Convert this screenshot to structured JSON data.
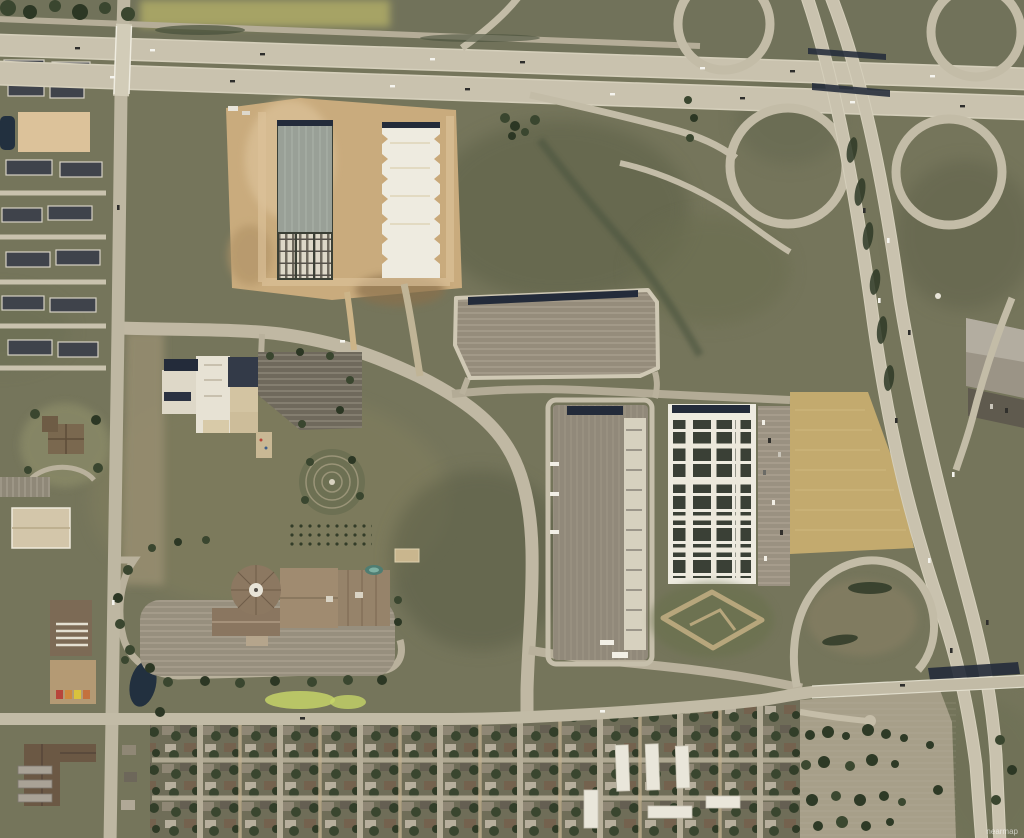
{
  "meta": {
    "title": "Aerial imagery - suburban freeway interchange and logistics district",
    "image_type": "orthographic aerial photograph",
    "watermark": "nearmap"
  },
  "palette": {
    "grass": "#75755b",
    "grass_dark": "#5c6046",
    "grass_light": "#8d8769",
    "scrub": "#837c60",
    "dirt": "#c9ab7d",
    "dirt_light": "#dcc29a",
    "road": "#c9c2ae",
    "road_minor": "#b9b19c",
    "asphalt": "#8f8878",
    "lot_dark": "#6e6859",
    "concrete": "#d7d1bf",
    "roof_white": "#eeebe0",
    "roof_gray": "#99a097",
    "navy": "#232b3a",
    "solar": "#3a4036",
    "tree": "#3a462f",
    "tree_dark": "#2c3724",
    "pond": "#22303f",
    "golden_field": "#c3aa6e",
    "lime": "#c6d468",
    "school_tan": "#d3c4a2",
    "church_brown": "#8c7861",
    "town_roof": "#3f434b"
  },
  "features": {
    "freeway_ew": "east-west freeway",
    "freeway_diagonal": "diagonal freeway",
    "interchange": "cloverleaf interchange",
    "construction": "warehouse construction site",
    "logistics": "logistics buildings and truck courts",
    "school": "school campus",
    "church": "domed church campus",
    "townhomes": "townhome subdivision",
    "residential": "residential street grid",
    "nursery": "tree nursery field",
    "golden_field": "golden crop field"
  }
}
